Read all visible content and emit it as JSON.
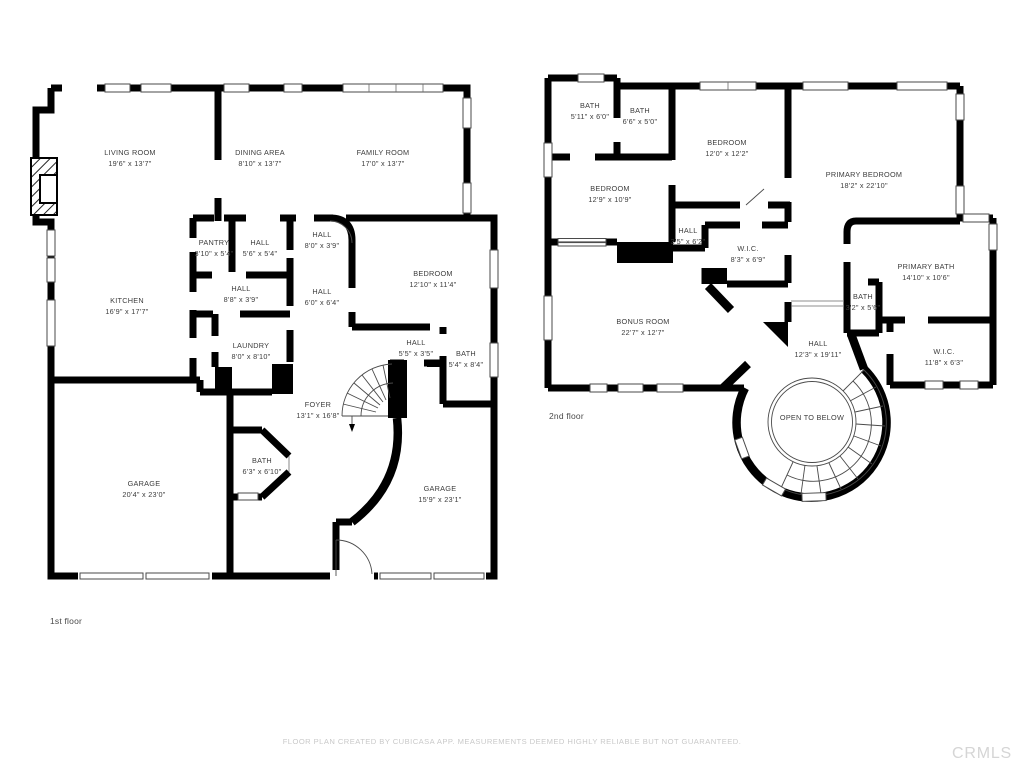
{
  "page": {
    "wall_color": "#000000",
    "background": "#ffffff",
    "text_color": "#3d3d3d",
    "muted_color": "#c9c9c9"
  },
  "floor1": {
    "label": "1st floor",
    "rooms": [
      {
        "name": "LIVING ROOM",
        "dims": "19'6\" x 13'7\""
      },
      {
        "name": "DINING AREA",
        "dims": "8'10\" x 13'7\""
      },
      {
        "name": "FAMILY ROOM",
        "dims": "17'0\" x 13'7\""
      },
      {
        "name": "PANTRY",
        "dims": "3'10\" x 5'4\""
      },
      {
        "name": "HALL",
        "dims": "5'6\" x 5'4\""
      },
      {
        "name": "HALL",
        "dims": "8'0\" x 3'9\""
      },
      {
        "name": "KITCHEN",
        "dims": "16'9\" x 17'7\""
      },
      {
        "name": "HALL",
        "dims": "8'8\" x 3'9\""
      },
      {
        "name": "HALL",
        "dims": "6'0\" x 6'4\""
      },
      {
        "name": "BEDROOM",
        "dims": "12'10\" x 11'4\""
      },
      {
        "name": "LAUNDRY",
        "dims": "8'0\" x 8'10\""
      },
      {
        "name": "HALL",
        "dims": "5'5\" x 3'5\""
      },
      {
        "name": "BATH",
        "dims": "5'4\" x 8'4\""
      },
      {
        "name": "FOYER",
        "dims": "13'1\" x 16'8\""
      },
      {
        "name": "BATH",
        "dims": "6'3\" x 6'10\""
      },
      {
        "name": "GARAGE",
        "dims": "20'4\" x 23'0\""
      },
      {
        "name": "GARAGE",
        "dims": "15'9\" x 23'1\""
      }
    ]
  },
  "floor2": {
    "label": "2nd floor",
    "open_to_below": "OPEN TO BELOW",
    "rooms": [
      {
        "name": "BATH",
        "dims": "5'11\" x 6'0\""
      },
      {
        "name": "BATH",
        "dims": "6'6\" x 5'0\""
      },
      {
        "name": "BEDROOM",
        "dims": "12'0\" x 12'2\""
      },
      {
        "name": "PRIMARY BEDROOM",
        "dims": "18'2\" x 22'10\""
      },
      {
        "name": "BEDROOM",
        "dims": "12'9\" x 10'9\""
      },
      {
        "name": "HALL",
        "dims": "3'5\" x 6'2\""
      },
      {
        "name": "W.I.C.",
        "dims": "8'3\" x 6'9\""
      },
      {
        "name": "PRIMARY BATH",
        "dims": "14'10\" x 10'6\""
      },
      {
        "name": "BATH",
        "dims": "3'2\" x 5'6\""
      },
      {
        "name": "W.I.C.",
        "dims": "11'8\" x 6'3\""
      },
      {
        "name": "BONUS ROOM",
        "dims": "22'7\" x 12'7\""
      },
      {
        "name": "HALL",
        "dims": "12'3\" x 19'11\""
      }
    ]
  },
  "footer": {
    "disclaimer": "FLOOR PLAN CREATED BY CUBICASA APP. MEASUREMENTS DEEMED HIGHLY RELIABLE BUT NOT GUARANTEED.",
    "watermark": "CRMLS"
  }
}
